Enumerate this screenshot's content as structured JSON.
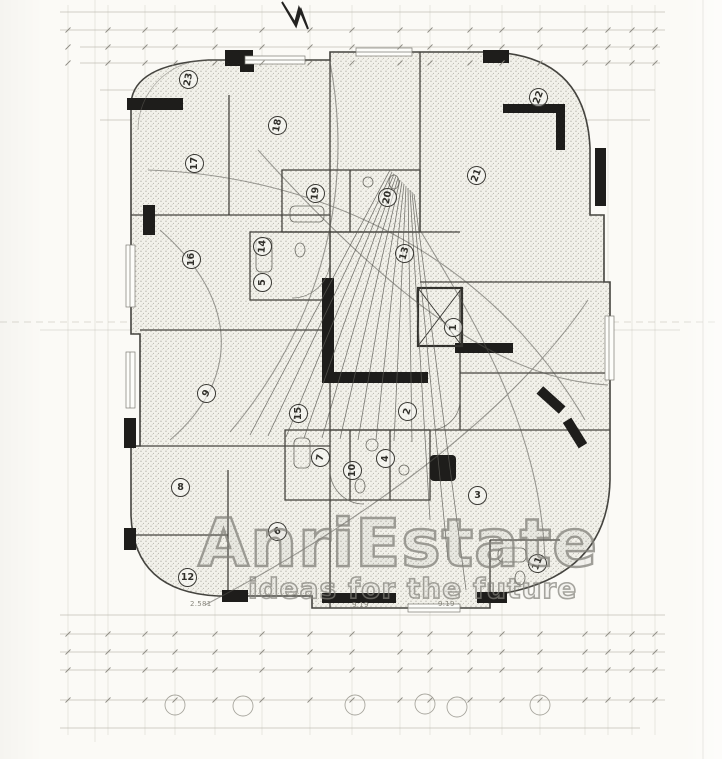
{
  "watermark": {
    "brand": "AnriEstate",
    "tagline": "ideas for the future"
  },
  "rooms": [
    {
      "n": "1",
      "x": 453,
      "y": 327,
      "rot": -90
    },
    {
      "n": "2",
      "x": 407,
      "y": 411,
      "rot": -75
    },
    {
      "n": "3",
      "x": 477,
      "y": 495,
      "rot": 0
    },
    {
      "n": "4",
      "x": 385,
      "y": 458,
      "rot": -90
    },
    {
      "n": "5",
      "x": 262,
      "y": 282,
      "rot": -90
    },
    {
      "n": "6",
      "x": 277,
      "y": 531,
      "rot": -30
    },
    {
      "n": "7",
      "x": 320,
      "y": 457,
      "rot": -80
    },
    {
      "n": "8",
      "x": 180,
      "y": 487,
      "rot": 0
    },
    {
      "n": "9",
      "x": 206,
      "y": 393,
      "rot": -60
    },
    {
      "n": "10",
      "x": 352,
      "y": 470,
      "rot": -90
    },
    {
      "n": "11",
      "x": 537,
      "y": 563,
      "rot": -70
    },
    {
      "n": "12",
      "x": 187,
      "y": 577,
      "rot": 0
    },
    {
      "n": "13",
      "x": 404,
      "y": 253,
      "rot": -75
    },
    {
      "n": "14",
      "x": 262,
      "y": 246,
      "rot": -85
    },
    {
      "n": "15",
      "x": 298,
      "y": 413,
      "rot": -90
    },
    {
      "n": "16",
      "x": 191,
      "y": 259,
      "rot": -90
    },
    {
      "n": "17",
      "x": 194,
      "y": 163,
      "rot": -90
    },
    {
      "n": "18",
      "x": 277,
      "y": 125,
      "rot": -80
    },
    {
      "n": "19",
      "x": 315,
      "y": 193,
      "rot": -85
    },
    {
      "n": "20",
      "x": 387,
      "y": 197,
      "rot": -80
    },
    {
      "n": "21",
      "x": 476,
      "y": 175,
      "rot": -70
    },
    {
      "n": "22",
      "x": 538,
      "y": 97,
      "rot": -70
    },
    {
      "n": "23",
      "x": 188,
      "y": 79,
      "rot": -80
    }
  ],
  "dim_labels": [
    {
      "text": "2.581",
      "x": 190,
      "y": 600
    },
    {
      "text": "9.19",
      "x": 352,
      "y": 601
    },
    {
      "text": "9.19",
      "x": 438,
      "y": 600
    }
  ],
  "colors": {
    "paper": "#fbfaf6",
    "ink": "#45443f",
    "poche": "#1e1d1b",
    "faint": "#bbb9af",
    "stipple": "#97958c",
    "watermark": "#82807a"
  }
}
